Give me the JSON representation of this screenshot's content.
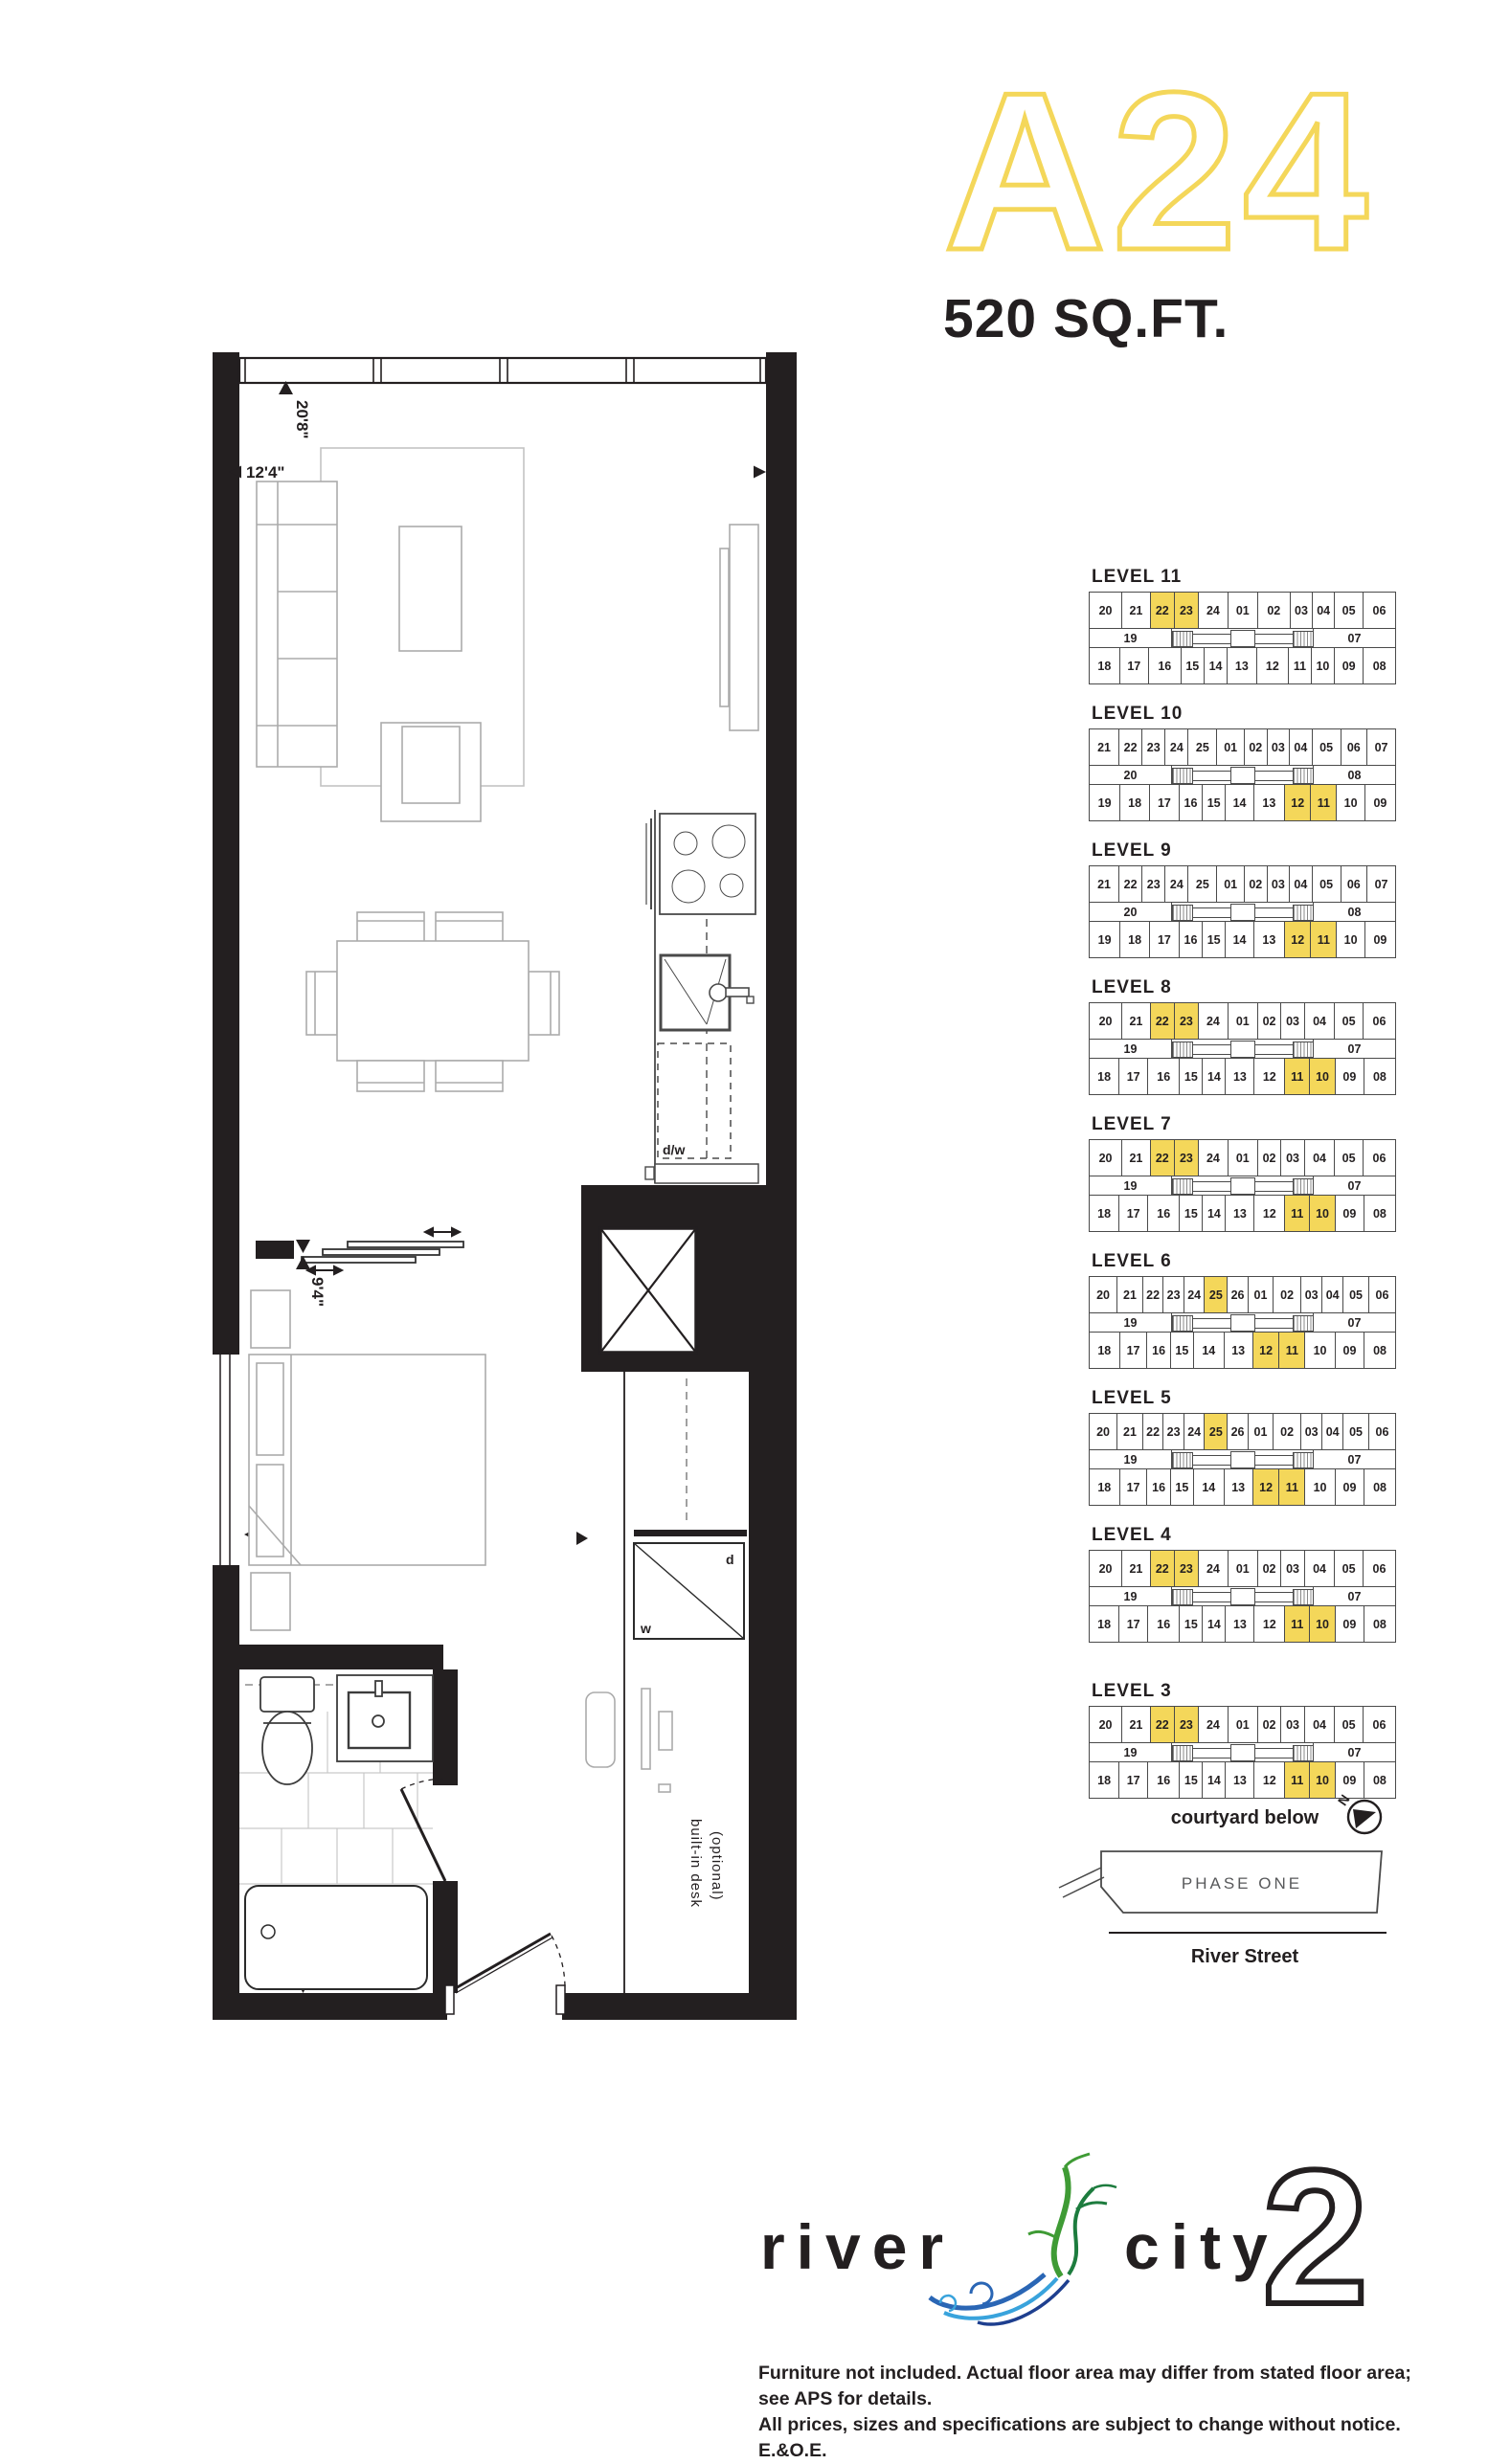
{
  "header": {
    "plan_code": "A24",
    "area": "520 SQ.FT."
  },
  "colors": {
    "highlight": "#F4D75A",
    "ink": "#231f20",
    "phase_text": "#58595b"
  },
  "floorplan": {
    "dims": {
      "living_length": "20'8\"",
      "living_width": "12'4\"",
      "bedroom_length": "9'4\"",
      "bedroom_width": "9'7\""
    },
    "labels": {
      "dishwasher": "d/w",
      "dryer": "d",
      "washer": "w",
      "desk_line1": "built-in desk",
      "desk_line2": "(optional)"
    }
  },
  "levels": [
    {
      "name": "LEVEL 11",
      "left": "19",
      "right": "07",
      "top": [
        {
          "n": "20",
          "w": 1.5
        },
        {
          "n": "21",
          "w": 1.15
        },
        {
          "n": "22",
          "w": 0.8,
          "hl": true
        },
        {
          "n": "23",
          "w": 0.8,
          "hl": true
        },
        {
          "n": "24",
          "w": 1.25
        },
        {
          "n": "01",
          "w": 1.25
        },
        {
          "n": "02",
          "w": 1.5
        },
        {
          "n": "03",
          "w": 0.65
        },
        {
          "n": "04",
          "w": 0.65
        },
        {
          "n": "05",
          "w": 1.15
        },
        {
          "n": "06",
          "w": 1.5
        }
      ],
      "bottom": [
        {
          "n": "18",
          "w": 1.25
        },
        {
          "n": "17",
          "w": 1.15
        },
        {
          "n": "16",
          "w": 1.4
        },
        {
          "n": "15",
          "w": 0.7
        },
        {
          "n": "14",
          "w": 0.7
        },
        {
          "n": "13",
          "w": 1.15
        },
        {
          "n": "12",
          "w": 1.4
        },
        {
          "n": "11",
          "w": 0.7
        },
        {
          "n": "10",
          "w": 0.7
        },
        {
          "n": "09",
          "w": 1.15
        },
        {
          "n": "08",
          "w": 1.4
        }
      ]
    },
    {
      "name": "LEVEL 10",
      "left": "20",
      "right": "08",
      "top": [
        {
          "n": "21",
          "w": 1.4
        },
        {
          "n": "22",
          "w": 0.8
        },
        {
          "n": "23",
          "w": 0.8
        },
        {
          "n": "24",
          "w": 0.8
        },
        {
          "n": "25",
          "w": 1.3
        },
        {
          "n": "01",
          "w": 1.2
        },
        {
          "n": "02",
          "w": 0.75
        },
        {
          "n": "03",
          "w": 0.75
        },
        {
          "n": "04",
          "w": 0.75
        },
        {
          "n": "05",
          "w": 1.3
        },
        {
          "n": "06",
          "w": 1.1
        },
        {
          "n": "07",
          "w": 1.3
        }
      ],
      "bottom": [
        {
          "n": "19",
          "w": 1.3
        },
        {
          "n": "18",
          "w": 1.2
        },
        {
          "n": "17",
          "w": 1.2
        },
        {
          "n": "16",
          "w": 0.7
        },
        {
          "n": "15",
          "w": 0.7
        },
        {
          "n": "14",
          "w": 1.1
        },
        {
          "n": "13",
          "w": 1.3
        },
        {
          "n": "12",
          "w": 0.95,
          "hl": true
        },
        {
          "n": "11",
          "w": 0.95,
          "hl": true
        },
        {
          "n": "10",
          "w": 1.1
        },
        {
          "n": "09",
          "w": 1.3
        }
      ]
    },
    {
      "name": "LEVEL 9",
      "left": "20",
      "right": "08",
      "top": [
        {
          "n": "21",
          "w": 1.4
        },
        {
          "n": "22",
          "w": 0.8
        },
        {
          "n": "23",
          "w": 0.8
        },
        {
          "n": "24",
          "w": 0.8
        },
        {
          "n": "25",
          "w": 1.3
        },
        {
          "n": "01",
          "w": 1.2
        },
        {
          "n": "02",
          "w": 0.75
        },
        {
          "n": "03",
          "w": 0.75
        },
        {
          "n": "04",
          "w": 0.75
        },
        {
          "n": "05",
          "w": 1.3
        },
        {
          "n": "06",
          "w": 1.1
        },
        {
          "n": "07",
          "w": 1.3
        }
      ],
      "bottom": [
        {
          "n": "19",
          "w": 1.3
        },
        {
          "n": "18",
          "w": 1.2
        },
        {
          "n": "17",
          "w": 1.2
        },
        {
          "n": "16",
          "w": 0.7
        },
        {
          "n": "15",
          "w": 0.7
        },
        {
          "n": "14",
          "w": 1.1
        },
        {
          "n": "13",
          "w": 1.3
        },
        {
          "n": "12",
          "w": 0.95,
          "hl": true
        },
        {
          "n": "11",
          "w": 0.95,
          "hl": true
        },
        {
          "n": "10",
          "w": 1.1
        },
        {
          "n": "09",
          "w": 1.3
        }
      ]
    },
    {
      "name": "LEVEL 8",
      "left": "19",
      "right": "07",
      "top": [
        {
          "n": "20",
          "w": 1.5
        },
        {
          "n": "21",
          "w": 1.15
        },
        {
          "n": "22",
          "w": 0.8,
          "hl": true
        },
        {
          "n": "23",
          "w": 0.8,
          "hl": true
        },
        {
          "n": "24",
          "w": 1.25
        },
        {
          "n": "01",
          "w": 1.25
        },
        {
          "n": "02",
          "w": 0.75
        },
        {
          "n": "03",
          "w": 0.75
        },
        {
          "n": "04",
          "w": 1.3
        },
        {
          "n": "05",
          "w": 1.15
        },
        {
          "n": "06",
          "w": 1.5
        }
      ],
      "bottom": [
        {
          "n": "18",
          "w": 1.25
        },
        {
          "n": "17",
          "w": 1.15
        },
        {
          "n": "16",
          "w": 1.4
        },
        {
          "n": "15",
          "w": 0.7
        },
        {
          "n": "14",
          "w": 0.7
        },
        {
          "n": "13",
          "w": 1.15
        },
        {
          "n": "12",
          "w": 1.3
        },
        {
          "n": "11",
          "w": 0.9,
          "hl": true
        },
        {
          "n": "10",
          "w": 0.9,
          "hl": true
        },
        {
          "n": "09",
          "w": 1.15
        },
        {
          "n": "08",
          "w": 1.4
        }
      ]
    },
    {
      "name": "LEVEL 7",
      "left": "19",
      "right": "07",
      "top": [
        {
          "n": "20",
          "w": 1.5
        },
        {
          "n": "21",
          "w": 1.15
        },
        {
          "n": "22",
          "w": 0.8,
          "hl": true
        },
        {
          "n": "23",
          "w": 0.8,
          "hl": true
        },
        {
          "n": "24",
          "w": 1.25
        },
        {
          "n": "01",
          "w": 1.25
        },
        {
          "n": "02",
          "w": 0.75
        },
        {
          "n": "03",
          "w": 0.75
        },
        {
          "n": "04",
          "w": 1.3
        },
        {
          "n": "05",
          "w": 1.15
        },
        {
          "n": "06",
          "w": 1.5
        }
      ],
      "bottom": [
        {
          "n": "18",
          "w": 1.25
        },
        {
          "n": "17",
          "w": 1.15
        },
        {
          "n": "16",
          "w": 1.4
        },
        {
          "n": "15",
          "w": 0.7
        },
        {
          "n": "14",
          "w": 0.7
        },
        {
          "n": "13",
          "w": 1.15
        },
        {
          "n": "12",
          "w": 1.3
        },
        {
          "n": "11",
          "w": 0.9,
          "hl": true
        },
        {
          "n": "10",
          "w": 0.9,
          "hl": true
        },
        {
          "n": "09",
          "w": 1.15
        },
        {
          "n": "08",
          "w": 1.4
        }
      ]
    },
    {
      "name": "LEVEL 6",
      "left": "19",
      "right": "07",
      "top": [
        {
          "n": "20",
          "w": 1.5
        },
        {
          "n": "21",
          "w": 1.25
        },
        {
          "n": "22",
          "w": 0.7
        },
        {
          "n": "23",
          "w": 0.7
        },
        {
          "n": "24",
          "w": 0.7
        },
        {
          "n": "25",
          "w": 0.95,
          "hl": true
        },
        {
          "n": "26",
          "w": 0.7
        },
        {
          "n": "01",
          "w": 1.2
        },
        {
          "n": "02",
          "w": 1.5
        },
        {
          "n": "03",
          "w": 0.75
        },
        {
          "n": "04",
          "w": 0.75
        },
        {
          "n": "05",
          "w": 1.25
        },
        {
          "n": "06",
          "w": 1.4
        }
      ],
      "bottom": [
        {
          "n": "18",
          "w": 1.25
        },
        {
          "n": "17",
          "w": 1.05
        },
        {
          "n": "16",
          "w": 0.7
        },
        {
          "n": "15",
          "w": 0.7
        },
        {
          "n": "14",
          "w": 1.25
        },
        {
          "n": "13",
          "w": 1.15
        },
        {
          "n": "12",
          "w": 0.95,
          "hl": true
        },
        {
          "n": "11",
          "w": 0.95,
          "hl": true
        },
        {
          "n": "10",
          "w": 1.25
        },
        {
          "n": "09",
          "w": 1.15
        },
        {
          "n": "08",
          "w": 1.35
        }
      ]
    },
    {
      "name": "LEVEL 5",
      "left": "19",
      "right": "07",
      "top": [
        {
          "n": "20",
          "w": 1.5
        },
        {
          "n": "21",
          "w": 1.25
        },
        {
          "n": "22",
          "w": 0.7
        },
        {
          "n": "23",
          "w": 0.7
        },
        {
          "n": "24",
          "w": 0.7
        },
        {
          "n": "25",
          "w": 0.95,
          "hl": true
        },
        {
          "n": "26",
          "w": 0.7
        },
        {
          "n": "01",
          "w": 1.2
        },
        {
          "n": "02",
          "w": 1.5
        },
        {
          "n": "03",
          "w": 0.75
        },
        {
          "n": "04",
          "w": 0.75
        },
        {
          "n": "05",
          "w": 1.25
        },
        {
          "n": "06",
          "w": 1.4
        }
      ],
      "bottom": [
        {
          "n": "18",
          "w": 1.25
        },
        {
          "n": "17",
          "w": 1.05
        },
        {
          "n": "16",
          "w": 0.7
        },
        {
          "n": "15",
          "w": 0.7
        },
        {
          "n": "14",
          "w": 1.25
        },
        {
          "n": "13",
          "w": 1.15
        },
        {
          "n": "12",
          "w": 0.95,
          "hl": true
        },
        {
          "n": "11",
          "w": 0.95,
          "hl": true
        },
        {
          "n": "10",
          "w": 1.25
        },
        {
          "n": "09",
          "w": 1.15
        },
        {
          "n": "08",
          "w": 1.35
        }
      ]
    },
    {
      "name": "LEVEL 4",
      "left": "19",
      "right": "07",
      "top": [
        {
          "n": "20",
          "w": 1.5
        },
        {
          "n": "21",
          "w": 1.15
        },
        {
          "n": "22",
          "w": 0.8,
          "hl": true
        },
        {
          "n": "23",
          "w": 0.8,
          "hl": true
        },
        {
          "n": "24",
          "w": 1.25
        },
        {
          "n": "01",
          "w": 1.25
        },
        {
          "n": "02",
          "w": 0.75
        },
        {
          "n": "03",
          "w": 0.75
        },
        {
          "n": "04",
          "w": 1.3
        },
        {
          "n": "05",
          "w": 1.15
        },
        {
          "n": "06",
          "w": 1.5
        }
      ],
      "bottom": [
        {
          "n": "18",
          "w": 1.25
        },
        {
          "n": "17",
          "w": 1.15
        },
        {
          "n": "16",
          "w": 1.4
        },
        {
          "n": "15",
          "w": 0.7
        },
        {
          "n": "14",
          "w": 0.7
        },
        {
          "n": "13",
          "w": 1.15
        },
        {
          "n": "12",
          "w": 1.3
        },
        {
          "n": "11",
          "w": 0.9,
          "hl": true
        },
        {
          "n": "10",
          "w": 0.9,
          "hl": true
        },
        {
          "n": "09",
          "w": 1.15
        },
        {
          "n": "08",
          "w": 1.4
        }
      ]
    },
    {
      "name": "LEVEL 3",
      "gap": true,
      "left": "19",
      "right": "07",
      "top": [
        {
          "n": "20",
          "w": 1.5
        },
        {
          "n": "21",
          "w": 1.15
        },
        {
          "n": "22",
          "w": 0.8,
          "hl": true
        },
        {
          "n": "23",
          "w": 0.8,
          "hl": true
        },
        {
          "n": "24",
          "w": 1.25
        },
        {
          "n": "01",
          "w": 1.25
        },
        {
          "n": "02",
          "w": 0.75
        },
        {
          "n": "03",
          "w": 0.75
        },
        {
          "n": "04",
          "w": 1.3
        },
        {
          "n": "05",
          "w": 1.15
        },
        {
          "n": "06",
          "w": 1.5
        }
      ],
      "bottom": [
        {
          "n": "18",
          "w": 1.25
        },
        {
          "n": "17",
          "w": 1.15
        },
        {
          "n": "16",
          "w": 1.4
        },
        {
          "n": "15",
          "w": 0.7
        },
        {
          "n": "14",
          "w": 0.7
        },
        {
          "n": "13",
          "w": 1.15
        },
        {
          "n": "12",
          "w": 1.3
        },
        {
          "n": "11",
          "w": 0.9,
          "hl": true
        },
        {
          "n": "10",
          "w": 0.9,
          "hl": true
        },
        {
          "n": "09",
          "w": 1.15
        },
        {
          "n": "08",
          "w": 1.4
        }
      ]
    }
  ],
  "site": {
    "courtyard": "courtyard below",
    "phase": "PHASE ONE",
    "street": "River Street",
    "north": "N"
  },
  "logo": {
    "river": "river",
    "city": "city",
    "two": "2"
  },
  "disclaimer": {
    "line1": "Furniture not included. Actual floor area may differ from stated floor area; see APS for details.",
    "line2": "All prices, sizes and specifications are subject to change without notice. E.&O.E."
  }
}
